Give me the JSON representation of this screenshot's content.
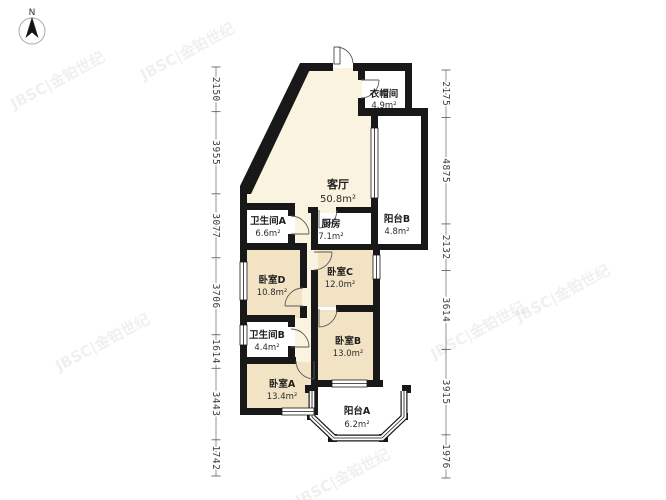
{
  "compass": {
    "label": "N"
  },
  "watermark": {
    "text": "JBSC|金铂世纪"
  },
  "rooms": [
    {
      "id": "cloakroom",
      "name": "衣帽间",
      "area": "4.9m²"
    },
    {
      "id": "living",
      "name": "客厅",
      "area": "50.8m²"
    },
    {
      "id": "kitchen",
      "name": "厨房",
      "area": "7.1m²"
    },
    {
      "id": "balcony-b",
      "name": "阳台B",
      "area": "4.8m²"
    },
    {
      "id": "bath-a",
      "name": "卫生间A",
      "area": "6.6m²"
    },
    {
      "id": "bed-d",
      "name": "卧室D",
      "area": "10.8m²"
    },
    {
      "id": "bed-c",
      "name": "卧室C",
      "area": "12.0m²"
    },
    {
      "id": "bath-b",
      "name": "卫生间B",
      "area": "4.4m²"
    },
    {
      "id": "bed-b",
      "name": "卧室B",
      "area": "13.0m²"
    },
    {
      "id": "bed-a",
      "name": "卧室A",
      "area": "13.4m²"
    },
    {
      "id": "balcony-a",
      "name": "阳台A",
      "area": "6.2m²"
    }
  ],
  "rulers": {
    "left": {
      "values": [
        2150,
        3955,
        3077,
        3706,
        1614,
        3443,
        1742
      ]
    },
    "right": {
      "values": [
        2175,
        4875,
        2132,
        3614,
        3915,
        1976
      ]
    }
  },
  "colors": {
    "wall": "#181818",
    "bedroom_fill": "#f2e3c5",
    "living_fill": "#faf3e0",
    "wet_room_fill": "#ffffff",
    "dim_text": "#3d3d3d"
  }
}
